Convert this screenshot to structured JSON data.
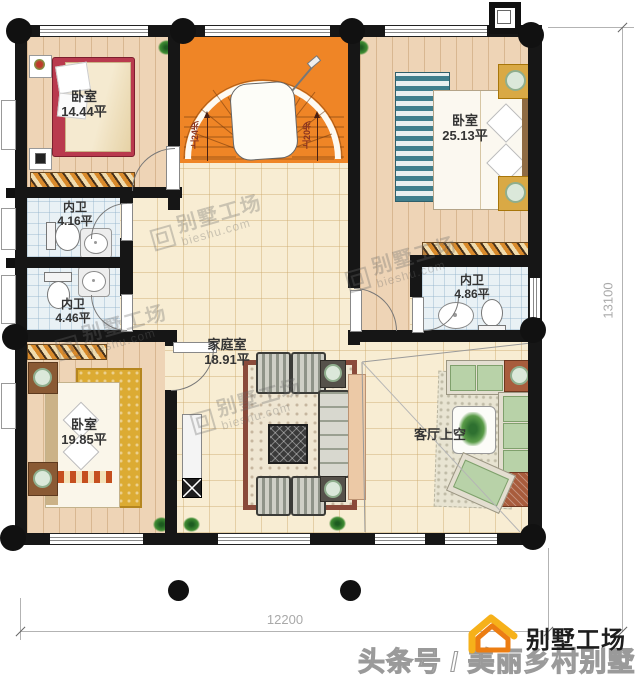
{
  "plan": {
    "rooms": {
      "bedroom_tl": {
        "name": "卧室",
        "area": "14.44平"
      },
      "bedroom_tr": {
        "name": "卧室",
        "area": "25.13平"
      },
      "bedroom_bl": {
        "name": "卧室",
        "area": "19.85平"
      },
      "bath_left_top": {
        "name": "内卫",
        "area": "4.16平"
      },
      "bath_left_bottom": {
        "name": "内卫",
        "area": "4.46平"
      },
      "bath_right": {
        "name": "内卫",
        "area": "4.86平"
      },
      "family_room": {
        "name": "家庭室",
        "area": "18.91平"
      },
      "living_void": {
        "name": "客厅上空"
      }
    },
    "stairs": {
      "label_left": "上24步",
      "label_right": "上20步"
    },
    "dimensions": {
      "width": "12200",
      "height": "13100"
    }
  },
  "watermark": {
    "brand": "别墅工场",
    "site": "bieshu.com"
  },
  "footer": {
    "channel": "头条号 / 美丽乡村别墅",
    "logo_text": "别墅工场"
  },
  "colors": {
    "wall": "#161616",
    "stair_orange": "#ef8526",
    "wood_floor": "#eed4b6",
    "tile_floor": "#f8edd3",
    "bath_floor": "#e9f1f5",
    "logo_orange": "#f2930f",
    "dim_gray": "#a9a9a9"
  }
}
